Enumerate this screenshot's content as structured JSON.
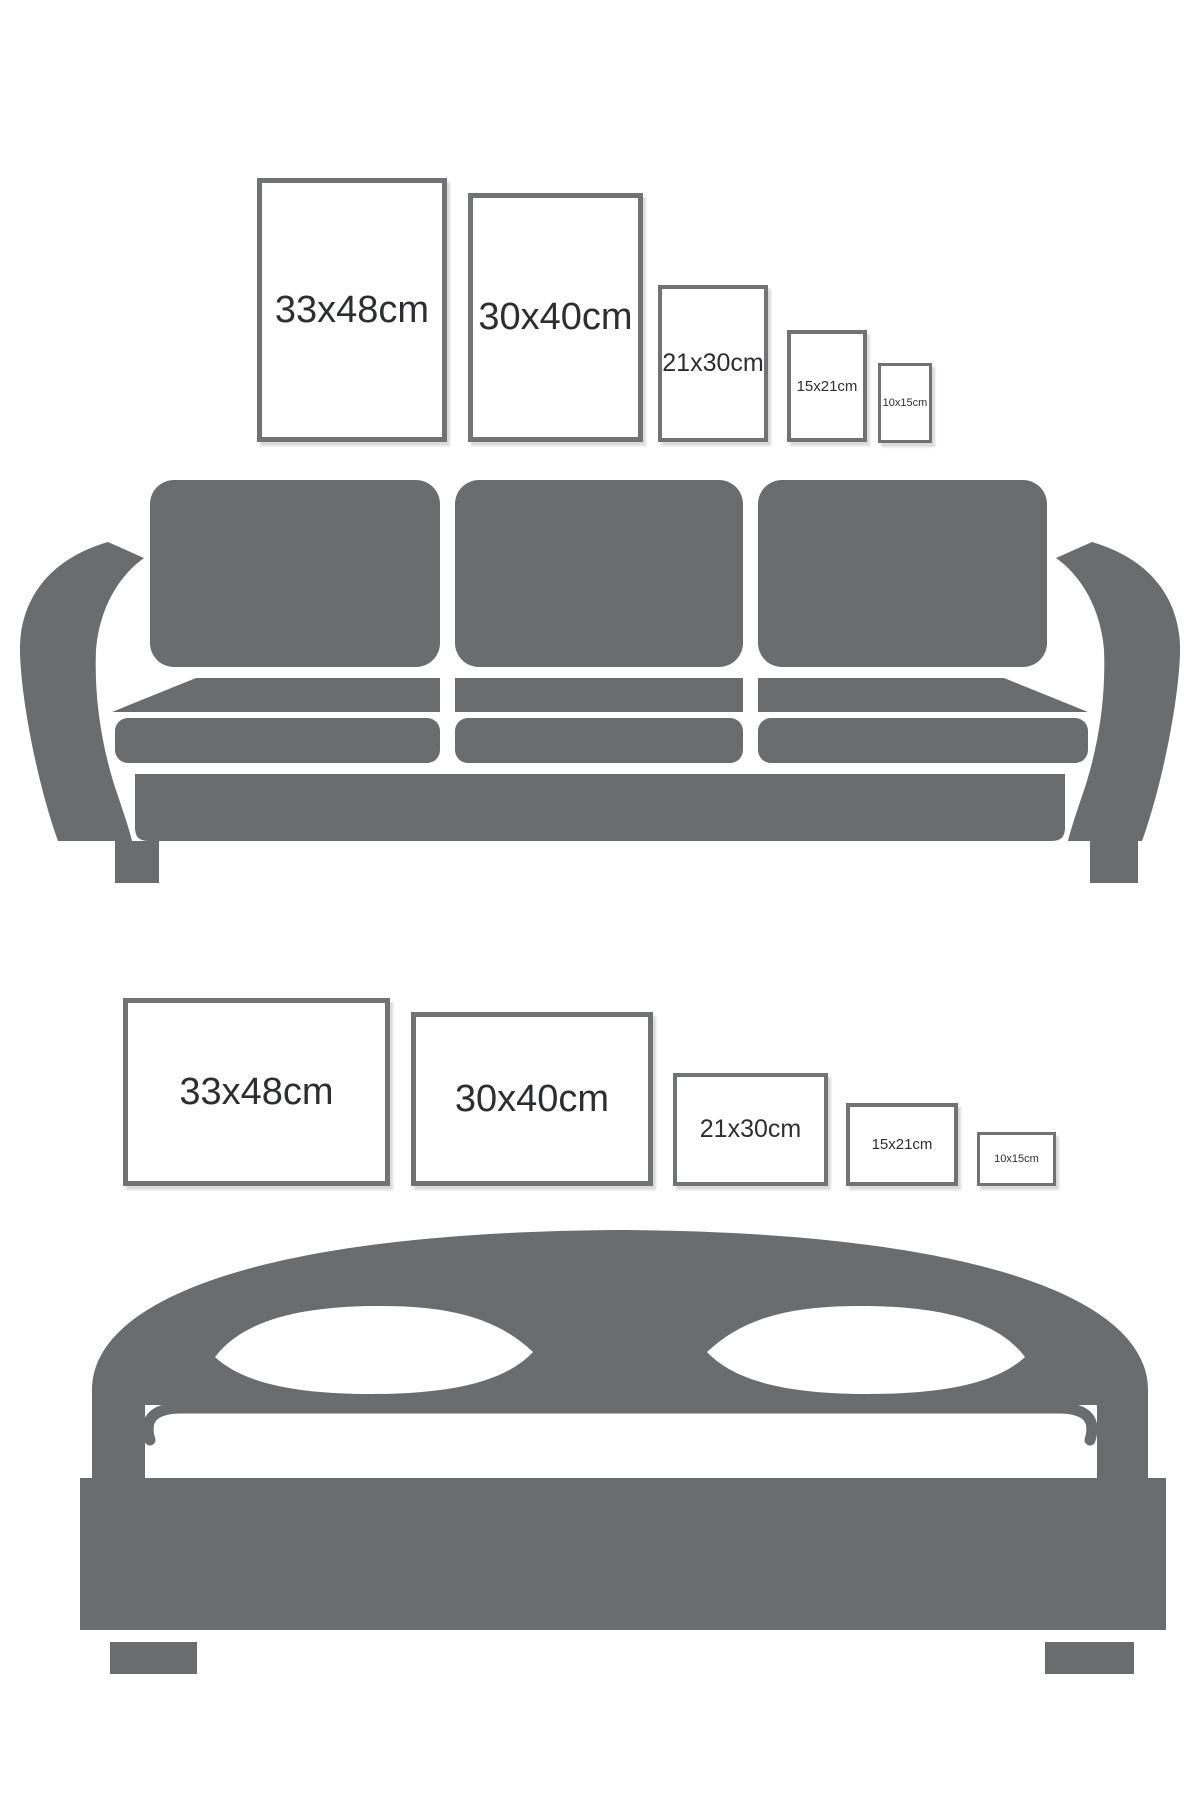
{
  "colors": {
    "background": "#ffffff",
    "furniture_gray": "#6a6c6e",
    "frame_border_gray": "#717274",
    "label_text": "#2d2e30"
  },
  "sofa_wall": {
    "furniture_icon": "sofa-silhouette",
    "frames": [
      {
        "label": "33x48cm",
        "orientation": "portrait"
      },
      {
        "label": "30x40cm",
        "orientation": "portrait"
      },
      {
        "label": "21x30cm",
        "orientation": "portrait"
      },
      {
        "label": "15x21cm",
        "orientation": "portrait"
      },
      {
        "label": "10x15cm",
        "orientation": "portrait"
      }
    ]
  },
  "bed_wall": {
    "furniture_icon": "bed-silhouette",
    "frames": [
      {
        "label": "33x48cm",
        "orientation": "landscape"
      },
      {
        "label": "30x40cm",
        "orientation": "landscape"
      },
      {
        "label": "21x30cm",
        "orientation": "landscape"
      },
      {
        "label": "15x21cm",
        "orientation": "landscape"
      },
      {
        "label": "10x15cm",
        "orientation": "landscape"
      }
    ]
  }
}
